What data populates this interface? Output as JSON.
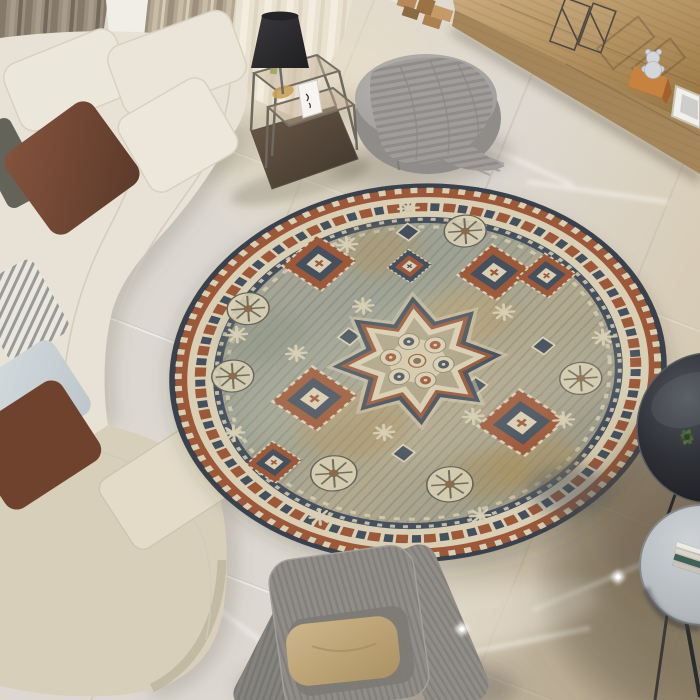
{
  "scene": {
    "type": "photograph",
    "setting": "Top-down view of a modern living room with marble floor",
    "focal_object": "Round vintage medallion area rug"
  },
  "objects": [
    {
      "name": "curved-sofa",
      "label": "cream curved modular sofa"
    },
    {
      "name": "pillow-brown",
      "label": "brown velvet pillow"
    },
    {
      "name": "pillow-blue",
      "label": "light blue pillow"
    },
    {
      "name": "pillow-ikat",
      "label": "white-gray patterned pillow"
    },
    {
      "name": "taupe-curtains",
      "label": "floor-length taupe curtains"
    },
    {
      "name": "sheer-curtain",
      "label": "sheer cream curtain"
    },
    {
      "name": "nesting-side-table",
      "label": "metal and glass nesting side table"
    },
    {
      "name": "table-lamp",
      "label": "black cone-shade table lamp"
    },
    {
      "name": "pouf",
      "label": "gray round pouf with draped knit throw"
    },
    {
      "name": "media-console",
      "label": "long wooden media console"
    },
    {
      "name": "wire-lanterns",
      "label": "wire-frame lantern decor"
    },
    {
      "name": "bear-figurine",
      "label": "crystal bear figurine on wood block"
    },
    {
      "name": "picture-frame",
      "label": "leaning white picture frame"
    },
    {
      "name": "round-rug",
      "label": "round distressed oriental rug"
    },
    {
      "name": "armchair",
      "label": "gray ribbed high-back armchair"
    },
    {
      "name": "armchair-pillow",
      "label": "tan pillow"
    },
    {
      "name": "side-table-dark",
      "label": "dark round nesting coffee tables"
    },
    {
      "name": "book-stack",
      "label": "stack of books"
    },
    {
      "name": "plant",
      "label": "small green plant"
    }
  ],
  "palette": {
    "floor_base": "#dcd8d1",
    "floor_vein": "#fbfaf7",
    "floor_shadow": "#6a5e4a",
    "curtain_dark": "#9a8e7e",
    "curtain_mid": "#b4a792",
    "sheer": "#eae2d1",
    "wall": "#f1eee8",
    "wood": "#b9945f",
    "wood_front": "#a5855a",
    "sofa_cream": "#e7e2d5",
    "sofa_khaki": "#d8cfba",
    "sofa_panel": "#6e6d60",
    "pillow_brown": "#6f4531",
    "pillow_blue": "#ccd4d8",
    "pillow_ikat": "#e9e7df",
    "pillow_tan": "#c1a878",
    "armchair": "#908d88",
    "pouf": "#a5a2a0",
    "blanket": "#989592",
    "lamp_shade": "#2b2a2c",
    "metal_frame": "#6d665c",
    "table_glass": "#c3ae93",
    "table_base": "#4e4137",
    "dark_table": "#23252a",
    "gray_table": "#b5b9bc",
    "plant": "#4c6340",
    "book": "#e9e6df",
    "rug_edge": "#39414d",
    "rug_rust": "#9c5839",
    "rug_cream": "#d9cfb4",
    "rug_navy": "#44505e",
    "rug_field": "#a3a092",
    "rug_ochre": "#b5975f"
  },
  "rug": {
    "center_x": 418,
    "center_y": 373,
    "radius_x": 249,
    "radius_y": 189,
    "rotation_deg": -4,
    "ring_radii": {
      "edge": 249,
      "rust_band": 243,
      "cream_band": 231,
      "motif_ring": 218,
      "navy_guard": 205,
      "field": 197
    },
    "patches": [
      {
        "x": 52,
        "y": -70,
        "r": 45,
        "c": "#b5975f"
      },
      {
        "x": -68,
        "y": 62,
        "r": 55,
        "c": "#b5975f"
      },
      {
        "x": 112,
        "y": 128,
        "r": 45,
        "c": "#b08f55"
      },
      {
        "x": -28,
        "y": -162,
        "r": 38,
        "c": "#b2935c"
      },
      {
        "x": 62,
        "y": 141,
        "r": 40,
        "c": "#a88e57"
      },
      {
        "x": 142,
        "y": 167,
        "r": 40,
        "c": "#44505e"
      },
      {
        "x": -150,
        "y": -60,
        "r": 42,
        "c": "#8f9585"
      }
    ],
    "motifs": {
      "medallion": [
        {
          "x": 0,
          "y": -16,
          "s": 1
        }
      ],
      "diamonds": [
        {
          "x": -91,
          "y": -153,
          "s": 1,
          "v": "rust"
        },
        {
          "x": 83,
          "y": -125,
          "s": 1,
          "v": "rust"
        },
        {
          "x": -105,
          "y": 24,
          "s": 1.15,
          "v": "rust"
        },
        {
          "x": 100,
          "y": 75,
          "s": 1.2,
          "v": "rust"
        },
        {
          "x": 135,
          "y": -116,
          "s": 0.8,
          "v": "rust"
        },
        {
          "x": -1,
          "y": -141,
          "s": 0.6,
          "v": "navy"
        },
        {
          "x": -150,
          "y": 104,
          "s": 0.75,
          "v": "rust"
        }
      ],
      "wheels": [
        {
          "x": 57,
          "y": -182,
          "s": 1
        },
        {
          "x": -165,
          "y": -100,
          "s": 1
        },
        {
          "x": -185,
          "y": -13,
          "s": 1
        },
        {
          "x": -91,
          "y": 124,
          "s": 1.1
        },
        {
          "x": 24,
          "y": 149,
          "s": 1.1
        },
        {
          "x": 162,
          "y": 22,
          "s": 1
        }
      ],
      "snowflakes": [
        {
          "x": 2,
          "y": -217
        },
        {
          "x": 90,
          "y": -72
        },
        {
          "x": -50,
          "y": -93
        },
        {
          "x": -178,
          "y": -67
        },
        {
          "x": -120,
          "y": -37
        },
        {
          "x": 34,
          "y": -43
        },
        {
          "x": 142,
          "y": 75
        },
        {
          "x": -38,
          "y": 75
        },
        {
          "x": -108,
          "y": 180
        },
        {
          "x": 52,
          "y": 193
        },
        {
          "x": 187,
          "y": -30
        },
        {
          "x": -188,
          "y": 62
        },
        {
          "x": -62,
          "y": -175
        },
        {
          "x": 52,
          "y": 62
        }
      ],
      "squares": [
        {
          "x": -66,
          "y": -54
        },
        {
          "x": 57,
          "y": 22
        },
        {
          "x": -20,
          "y": 104
        },
        {
          "x": 127,
          "y": -24
        },
        {
          "x": 0,
          "y": -186
        }
      ]
    }
  },
  "sparkles": [
    {
      "x": 462,
      "y": 629
    },
    {
      "x": 618,
      "y": 577
    }
  ]
}
